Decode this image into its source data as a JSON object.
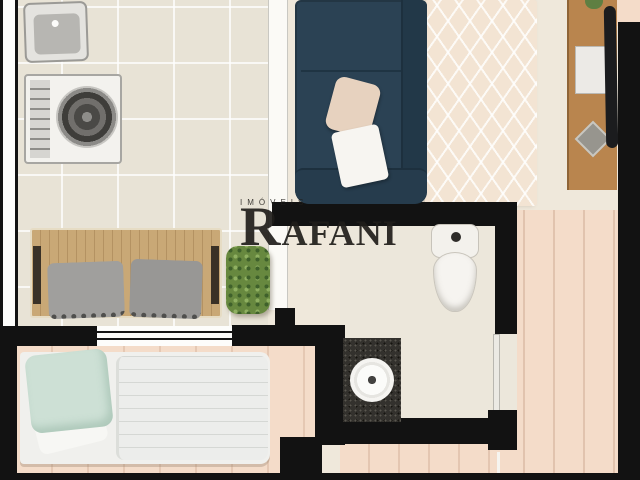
{
  "watermark": {
    "brand": "RAFANI",
    "tagline": "IMÓVEIS"
  },
  "palette": {
    "wall": "#121212",
    "tile_floor": "#e8e3d6",
    "living_floor": "#efe8db",
    "bath_floor": "#ece7db",
    "wood_floor": "#f4dcc9",
    "rug": "#f3e4d3",
    "sofa": "#2b4254",
    "sofa_dark": "#223848",
    "bench_wood": "#c9a876",
    "pillow_gray": "#a09f9d",
    "mint": "#cde0d5",
    "plant": "#67883f",
    "granite": "#33312d",
    "console_wood": "#b9854e",
    "white_goods": "#f3f2ee"
  }
}
